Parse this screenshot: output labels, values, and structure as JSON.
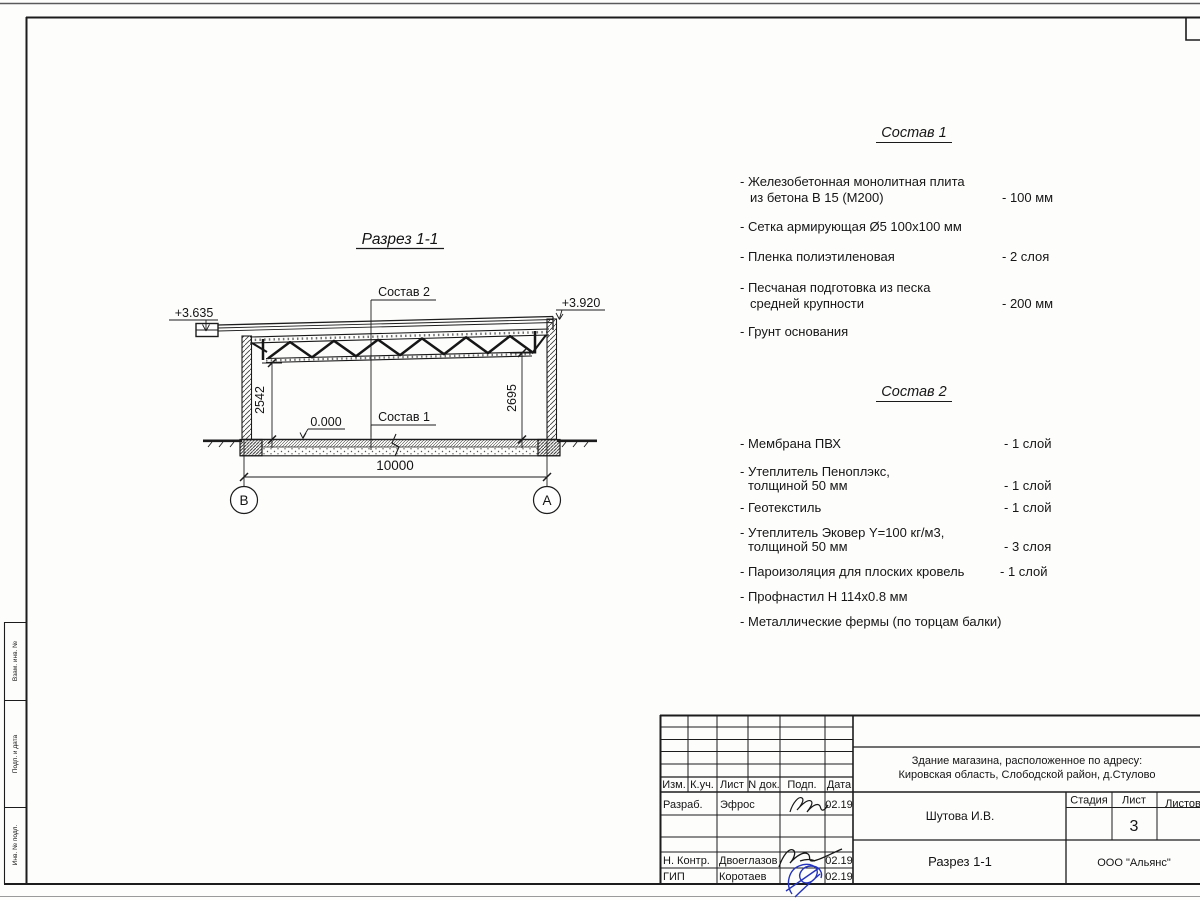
{
  "drawing": {
    "title": "Разрез 1-1",
    "composition2_label": "Состав 2",
    "composition1_label": "Состав 1",
    "elevation_left": "+3.635",
    "elevation_right": "+3.920",
    "level_zero": "0.000",
    "dim_height_left": "2542",
    "dim_height_right": "2695",
    "dim_span": "10000",
    "axis_left": "В",
    "axis_right": "А"
  },
  "composition1": {
    "title": "Состав 1",
    "items": [
      {
        "line1": "- Железобетонная  монолитная плита",
        "line2": "из бетона В 15 (М200)",
        "value": "- 100 мм"
      },
      {
        "line1": "- Сетка армирующая Ø5 100х100 мм",
        "line2": "",
        "value": ""
      },
      {
        "line1": "- Пленка полиэтиленовая",
        "line2": "",
        "value": "-  2 слоя"
      },
      {
        "line1": "- Песчаная подготовка из песка",
        "line2": "средней крупности",
        "value": "- 200 мм"
      },
      {
        "line1": "- Грунт основания",
        "line2": "",
        "value": ""
      }
    ]
  },
  "composition2": {
    "title": "Состав 2",
    "items": [
      {
        "line1": "- Мембрана ПВХ",
        "line2": "",
        "value": "- 1 слой"
      },
      {
        "line1": "- Утеплитель Пеноплэкс,",
        "line2": "толщиной 50 мм",
        "value": "- 1 слой"
      },
      {
        "line1": "- Геотекстиль",
        "line2": "",
        "value": "- 1 слой"
      },
      {
        "line1": "- Утеплитель Эковер Y=100 кг/м3,",
        "line2": "толщиной 50 мм",
        "value": "- 3 слоя"
      },
      {
        "line1": "- Пароизоляция для плоских кровель",
        "line2": "",
        "value": "- 1 слой"
      },
      {
        "line1": "- Профнастил Н 114х0.8 мм",
        "line2": "",
        "value": ""
      },
      {
        "line1": "- Металлические фермы (по торцам балки)",
        "line2": "",
        "value": ""
      }
    ]
  },
  "title_block": {
    "revision_headers": {
      "izm": "Изм.",
      "kuch": "К.уч.",
      "list": "Лист",
      "ndoc": "N док.",
      "podp": "Подп.",
      "data": "Дата"
    },
    "signature_rows": [
      {
        "role": "Разраб.",
        "name": "Эфрос",
        "date": "02.19"
      },
      {
        "role": "Н. Контр.",
        "name": "Двоеглазов",
        "date": "02.19"
      },
      {
        "role": "ГИП",
        "name": "Коротаев",
        "date": "02.19"
      }
    ],
    "project_line1": "Здание магазина, расположенное по адресу:",
    "project_line2": "Кировская область, Слободской район, д.Стулово",
    "author": "Шутова И.В.",
    "doc_title": "Разрез 1-1",
    "stage_label": "Стадия",
    "sheet_label": "Лист",
    "sheets_label": "Листов",
    "sheet_number": "3",
    "company": "ООО \"Альянс\""
  },
  "left_margin": {
    "labels": [
      "Взам. инв. №",
      "Подп. и дата",
      "Инв. № подл."
    ]
  },
  "colors": {
    "ink": "#1c1c1c",
    "signature_blue": "#2433bb"
  }
}
